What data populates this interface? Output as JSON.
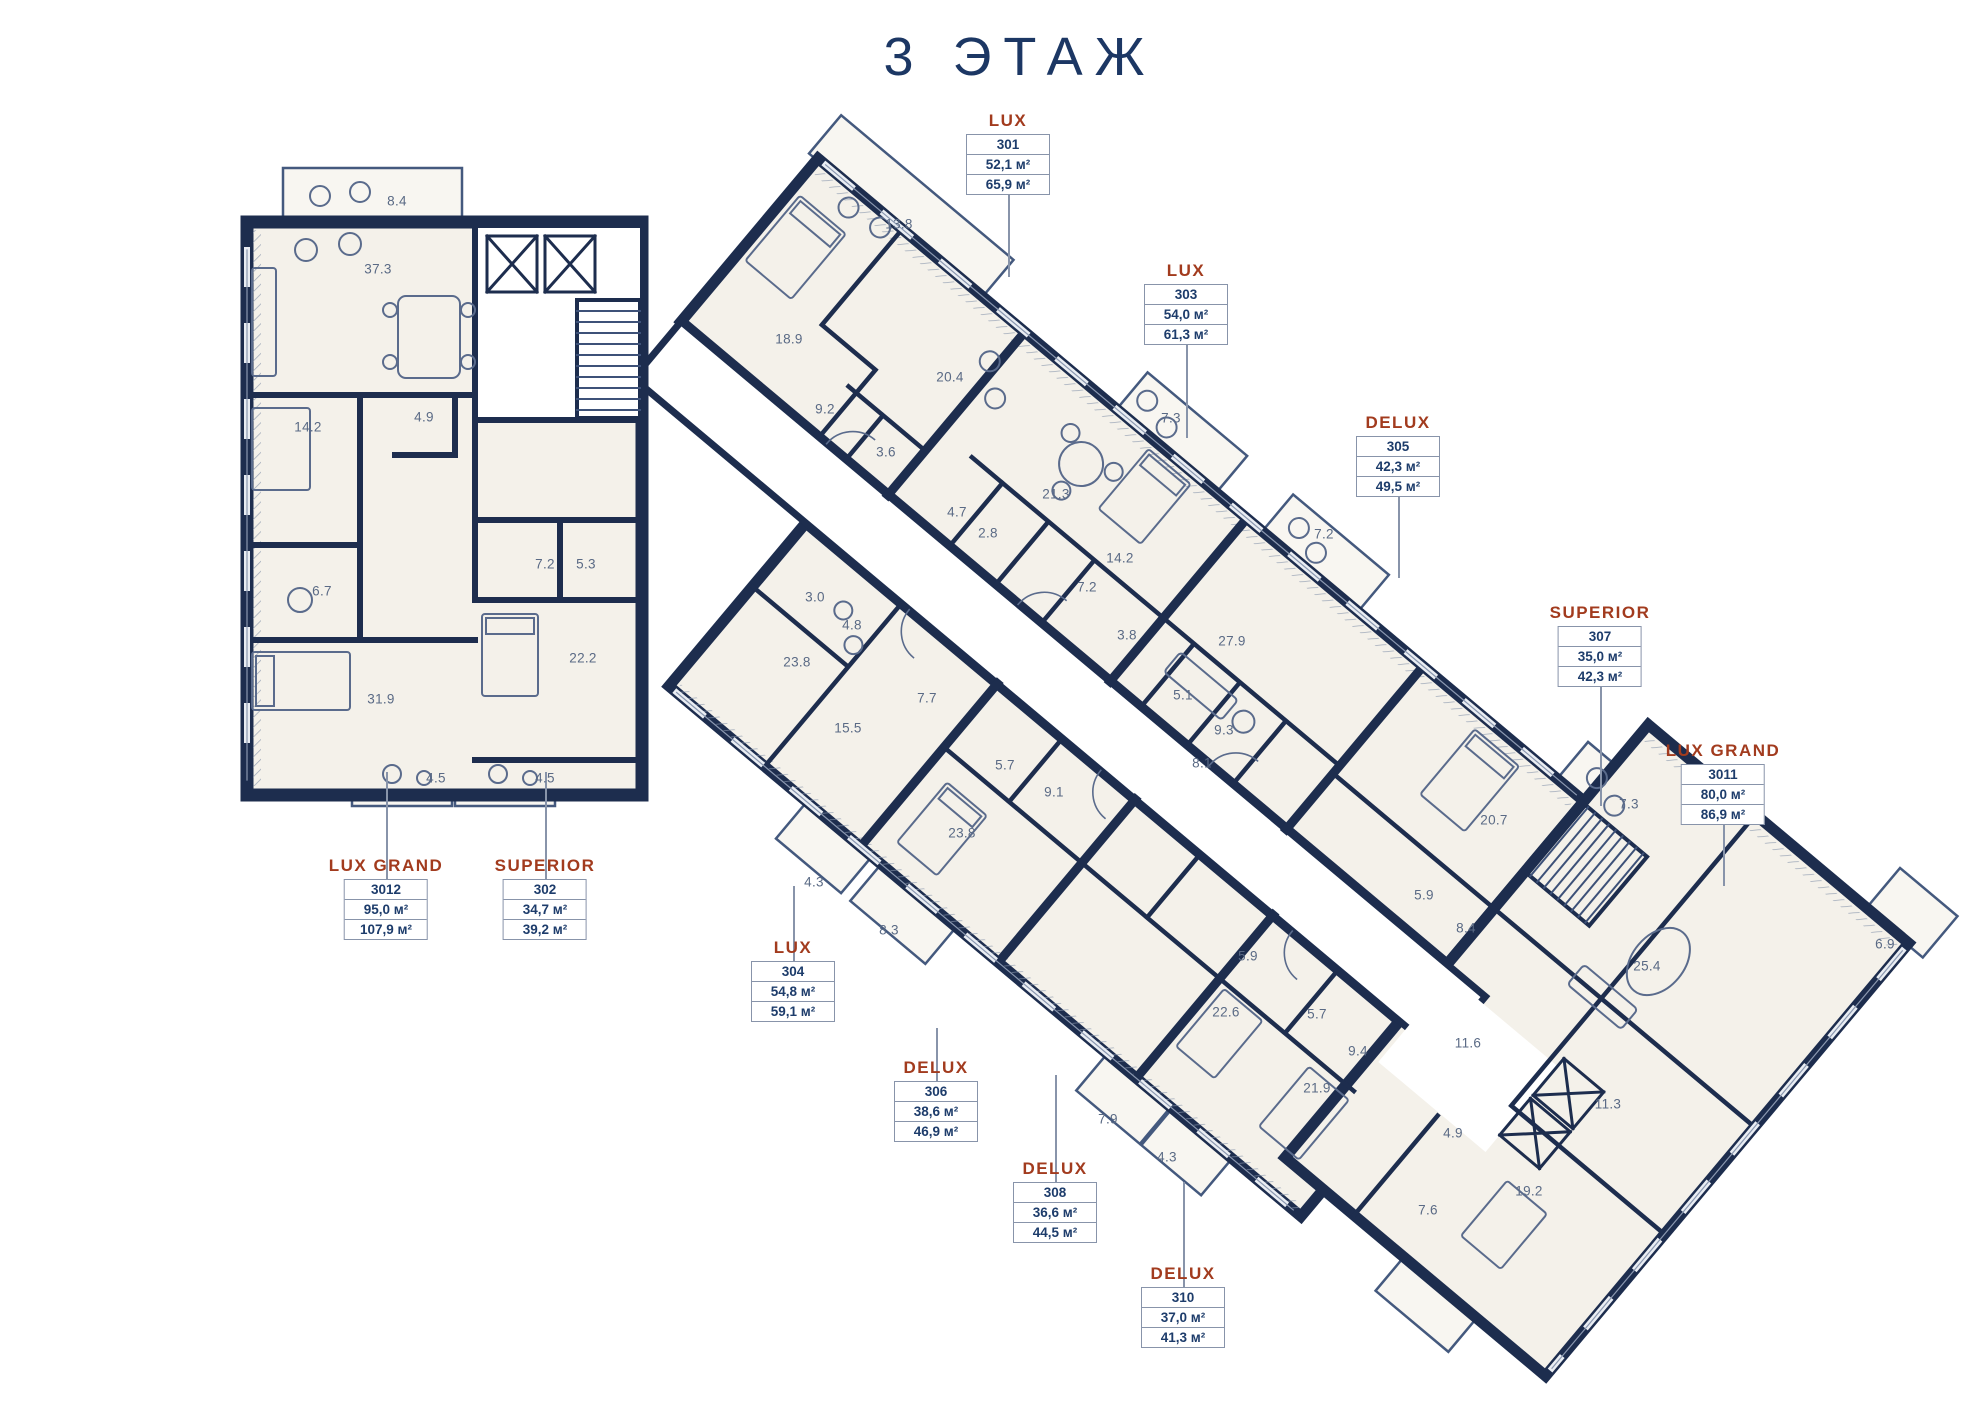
{
  "title": "3  ЭТАЖ",
  "colors": {
    "title_navy": "#1c3764",
    "category_rust": "#a23b1e",
    "wall_navy": "#1d2d4e",
    "room_fill": "#f4f1ea",
    "balcony_fill": "#f8f6f1",
    "furniture_slate": "#5a6b8c",
    "room_number_gray": "#5a6a85",
    "label_border": "#8894aa"
  },
  "units": [
    {
      "category": "LUX",
      "number": "301",
      "area_small": "52,1 м²",
      "area_large": "65,9 м²",
      "x": 1008,
      "box_top": 135,
      "leader_y1": 188,
      "leader_y2": 277
    },
    {
      "category": "SUPERIOR",
      "number": "302",
      "area_small": "34,7 м²",
      "area_large": "39,2 м²",
      "x": 545,
      "box_top": 880,
      "leader_y1": 772,
      "leader_y2": 879
    },
    {
      "category": "LUX",
      "number": "303",
      "area_small": "54,0 м²",
      "area_large": "61,3 м²",
      "x": 1186,
      "box_top": 285,
      "leader_y1": 338,
      "leader_y2": 438
    },
    {
      "category": "LUX",
      "number": "304",
      "area_small": "54,8 м²",
      "area_large": "59,1 м²",
      "x": 793,
      "box_top": 962,
      "leader_y1": 886,
      "leader_y2": 961
    },
    {
      "category": "DELUX",
      "number": "305",
      "area_small": "42,3 м²",
      "area_large": "49,5 м²",
      "x": 1398,
      "box_top": 437,
      "leader_y1": 490,
      "leader_y2": 578
    },
    {
      "category": "DELUX",
      "number": "306",
      "area_small": "38,6 м²",
      "area_large": "46,9 м²",
      "x": 936,
      "box_top": 1082,
      "leader_y1": 1028,
      "leader_y2": 1081
    },
    {
      "category": "SUPERIOR",
      "number": "307",
      "area_small": "35,0 м²",
      "area_large": "42,3 м²",
      "x": 1600,
      "box_top": 627,
      "leader_y1": 680,
      "leader_y2": 806
    },
    {
      "category": "DELUX",
      "number": "308",
      "area_small": "36,6 м²",
      "area_large": "44,5 м²",
      "x": 1055,
      "box_top": 1183,
      "leader_y1": 1075,
      "leader_y2": 1182
    },
    {
      "category": "DELUX",
      "number": "310",
      "area_small": "37,0 м²",
      "area_large": "41,3 м²",
      "x": 1183,
      "box_top": 1288,
      "leader_y1": 1182,
      "leader_y2": 1287
    },
    {
      "category": "LUX GRAND",
      "number": "3011",
      "area_small": "80,0 м²",
      "area_large": "86,9 м²",
      "x": 1723,
      "box_top": 765,
      "leader_y1": 818,
      "leader_y2": 886
    },
    {
      "category": "LUX GRAND",
      "number": "3012",
      "area_small": "95,0 м²",
      "area_large": "107,9 м²",
      "x": 386,
      "box_top": 880,
      "leader_y1": 772,
      "leader_y2": 879
    }
  ],
  "room_areas": [
    {
      "v": "8.4",
      "x": 397,
      "y": 201
    },
    {
      "v": "37.3",
      "x": 378,
      "y": 269
    },
    {
      "v": "13.8",
      "x": 899,
      "y": 224
    },
    {
      "v": "18.9",
      "x": 789,
      "y": 339
    },
    {
      "v": "20.4",
      "x": 950,
      "y": 377
    },
    {
      "v": "9.2",
      "x": 825,
      "y": 409
    },
    {
      "v": "14.2",
      "x": 308,
      "y": 427
    },
    {
      "v": "4.9",
      "x": 424,
      "y": 417
    },
    {
      "v": "7.3",
      "x": 1171,
      "y": 418
    },
    {
      "v": "3.6",
      "x": 886,
      "y": 452
    },
    {
      "v": "21.3",
      "x": 1056,
      "y": 494
    },
    {
      "v": "4.7",
      "x": 957,
      "y": 512
    },
    {
      "v": "2.8",
      "x": 988,
      "y": 533
    },
    {
      "v": "14.2",
      "x": 1120,
      "y": 558
    },
    {
      "v": "7.2",
      "x": 1087,
      "y": 587
    },
    {
      "v": "7.2",
      "x": 1324,
      "y": 534
    },
    {
      "v": "7.2",
      "x": 545,
      "y": 564
    },
    {
      "v": "5.3",
      "x": 586,
      "y": 564
    },
    {
      "v": "3.8",
      "x": 1127,
      "y": 635
    },
    {
      "v": "6.7",
      "x": 322,
      "y": 591
    },
    {
      "v": "3.0",
      "x": 815,
      "y": 597
    },
    {
      "v": "4.8",
      "x": 852,
      "y": 625
    },
    {
      "v": "27.9",
      "x": 1232,
      "y": 641
    },
    {
      "v": "23.8",
      "x": 797,
      "y": 662
    },
    {
      "v": "7.7",
      "x": 927,
      "y": 698
    },
    {
      "v": "5.1",
      "x": 1183,
      "y": 695
    },
    {
      "v": "31.9",
      "x": 381,
      "y": 699
    },
    {
      "v": "22.2",
      "x": 583,
      "y": 658
    },
    {
      "v": "9.3",
      "x": 1224,
      "y": 730
    },
    {
      "v": "15.5",
      "x": 848,
      "y": 728
    },
    {
      "v": "4.5",
      "x": 436,
      "y": 778
    },
    {
      "v": "4.5",
      "x": 545,
      "y": 778
    },
    {
      "v": "5.7",
      "x": 1005,
      "y": 765
    },
    {
      "v": "8.1",
      "x": 1202,
      "y": 763
    },
    {
      "v": "9.1",
      "x": 1054,
      "y": 792
    },
    {
      "v": "23.8",
      "x": 962,
      "y": 833
    },
    {
      "v": "20.7",
      "x": 1494,
      "y": 820
    },
    {
      "v": "7.3",
      "x": 1629,
      "y": 804
    },
    {
      "v": "4.3",
      "x": 814,
      "y": 882
    },
    {
      "v": "8.3",
      "x": 889,
      "y": 930
    },
    {
      "v": "5.9",
      "x": 1424,
      "y": 895
    },
    {
      "v": "8.4",
      "x": 1466,
      "y": 928
    },
    {
      "v": "5.9",
      "x": 1248,
      "y": 956
    },
    {
      "v": "25.4",
      "x": 1647,
      "y": 966
    },
    {
      "v": "6.9",
      "x": 1885,
      "y": 944
    },
    {
      "v": "22.6",
      "x": 1226,
      "y": 1012
    },
    {
      "v": "5.7",
      "x": 1317,
      "y": 1014
    },
    {
      "v": "9.4",
      "x": 1358,
      "y": 1051
    },
    {
      "v": "11.6",
      "x": 1468,
      "y": 1043
    },
    {
      "v": "21.9",
      "x": 1317,
      "y": 1088
    },
    {
      "v": "11.3",
      "x": 1608,
      "y": 1104
    },
    {
      "v": "7.9",
      "x": 1108,
      "y": 1119
    },
    {
      "v": "4.3",
      "x": 1167,
      "y": 1157
    },
    {
      "v": "4.9",
      "x": 1453,
      "y": 1133
    },
    {
      "v": "7.6",
      "x": 1428,
      "y": 1210
    },
    {
      "v": "19.2",
      "x": 1529,
      "y": 1191
    }
  ]
}
